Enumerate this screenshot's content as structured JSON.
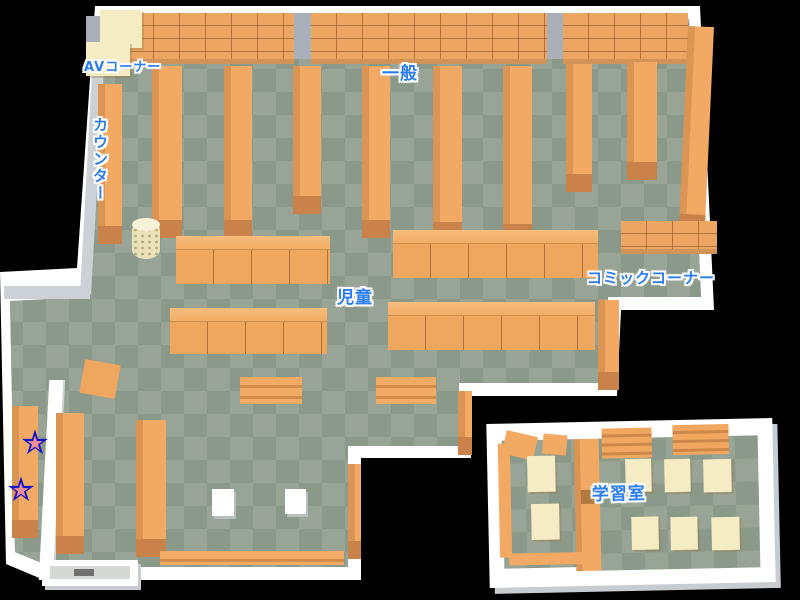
{
  "map": {
    "name": "library-floor-map",
    "labels": {
      "av_corner": "AVコーナー",
      "general": "一般",
      "counter": "カウンター",
      "children": "児童",
      "comic_corner": "コミックコーナー",
      "study_room": "学習室"
    },
    "markers": {
      "star_glyph": "★",
      "stars": [
        {
          "id": "star-marker-1",
          "fill": "#f48e90",
          "outline": "#1515c8"
        },
        {
          "id": "star-marker-2",
          "fill": "#f48e90",
          "outline": "#1515c8"
        }
      ]
    },
    "colors": {
      "background": "#000000",
      "wall": "#ffffff",
      "wall_shadow": "#c7ccd1",
      "floor_light": "#98a495",
      "floor_dark": "#8a9989",
      "shelf_orange": "#f1a963",
      "shelf_dark": "#c9834a",
      "furniture_cream": "#f6ecc3",
      "label_blue": "#2a7cf0"
    }
  }
}
